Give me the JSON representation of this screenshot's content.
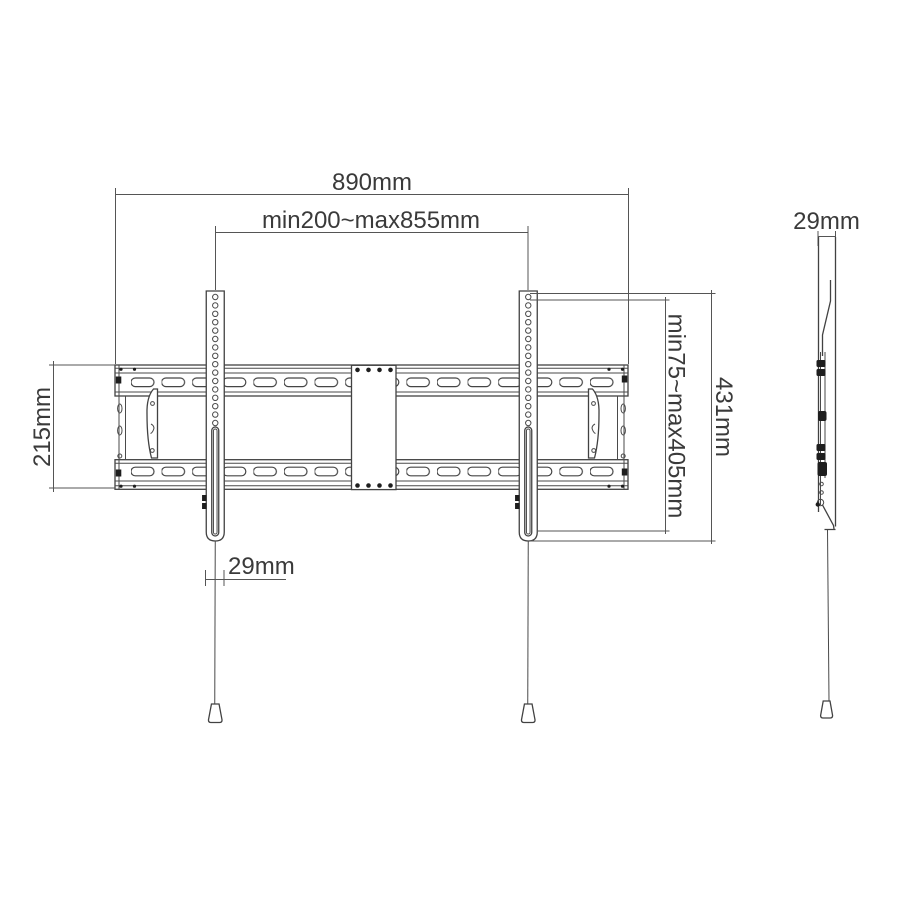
{
  "drawing_title": "TV wall mount bracket dimension drawing",
  "colors": {
    "background": "#ffffff",
    "line": "#424242",
    "dimension_line": "#555555",
    "text": "#3a3a3a",
    "hardware_fill": "#1e1e1e"
  },
  "front_view": {
    "dimensions": {
      "overall_width": "890mm",
      "horizontal_mount_range": "min200~max855mm",
      "wall_plate_height": "215mm",
      "bracket_height": "431mm",
      "vertical_mount_range": "min75~max405mm",
      "bracket_width": "29mm"
    }
  },
  "side_view": {
    "dimensions": {
      "profile_depth": "29mm"
    }
  }
}
